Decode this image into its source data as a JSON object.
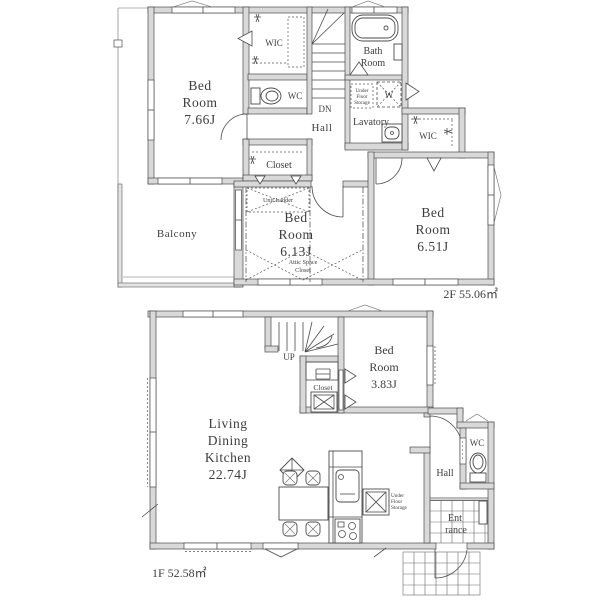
{
  "document": {
    "type": "residential-floor-plan"
  },
  "colors": {
    "wall_fill": "#d9d9d9",
    "wall_stroke": "#4b4b4b",
    "text": "#3d3d3d",
    "background": "#ffffff"
  },
  "floor2": {
    "area_label": "2F 55.06㎡",
    "bedroom1": [
      "Bed",
      "Room",
      "7.66J"
    ],
    "wic1": "WIC",
    "wc": "WC",
    "dn": "DN",
    "hall": "Hall",
    "bath": [
      "Bath",
      "Room"
    ],
    "lavatory": "Lavatory",
    "underfloor": [
      "Under",
      "Floor",
      "Storage"
    ],
    "washer": "W",
    "wic2": "WIC",
    "closet": "Closet",
    "unit_ladder": "Unit Ladder",
    "bedroom2": [
      "Bed",
      "Room",
      "6.13J"
    ],
    "attic": [
      "Attic Space",
      "Closet"
    ],
    "balcony": "Balcony",
    "bedroom3": [
      "Bed",
      "Room",
      "6.51J"
    ]
  },
  "floor1": {
    "area_label": "1F 52.58㎡",
    "up": "UP",
    "closet": "Closet",
    "bedroom": [
      "Bed",
      "Room",
      "3.83J"
    ],
    "ldk": [
      "Living",
      "Dining",
      "Kitchen",
      "22.74J"
    ],
    "underfloor": [
      "Under",
      "Floor",
      "Storage"
    ],
    "wc": "WC",
    "hall": "Hall",
    "entrance": [
      "Ent",
      "rance"
    ]
  }
}
